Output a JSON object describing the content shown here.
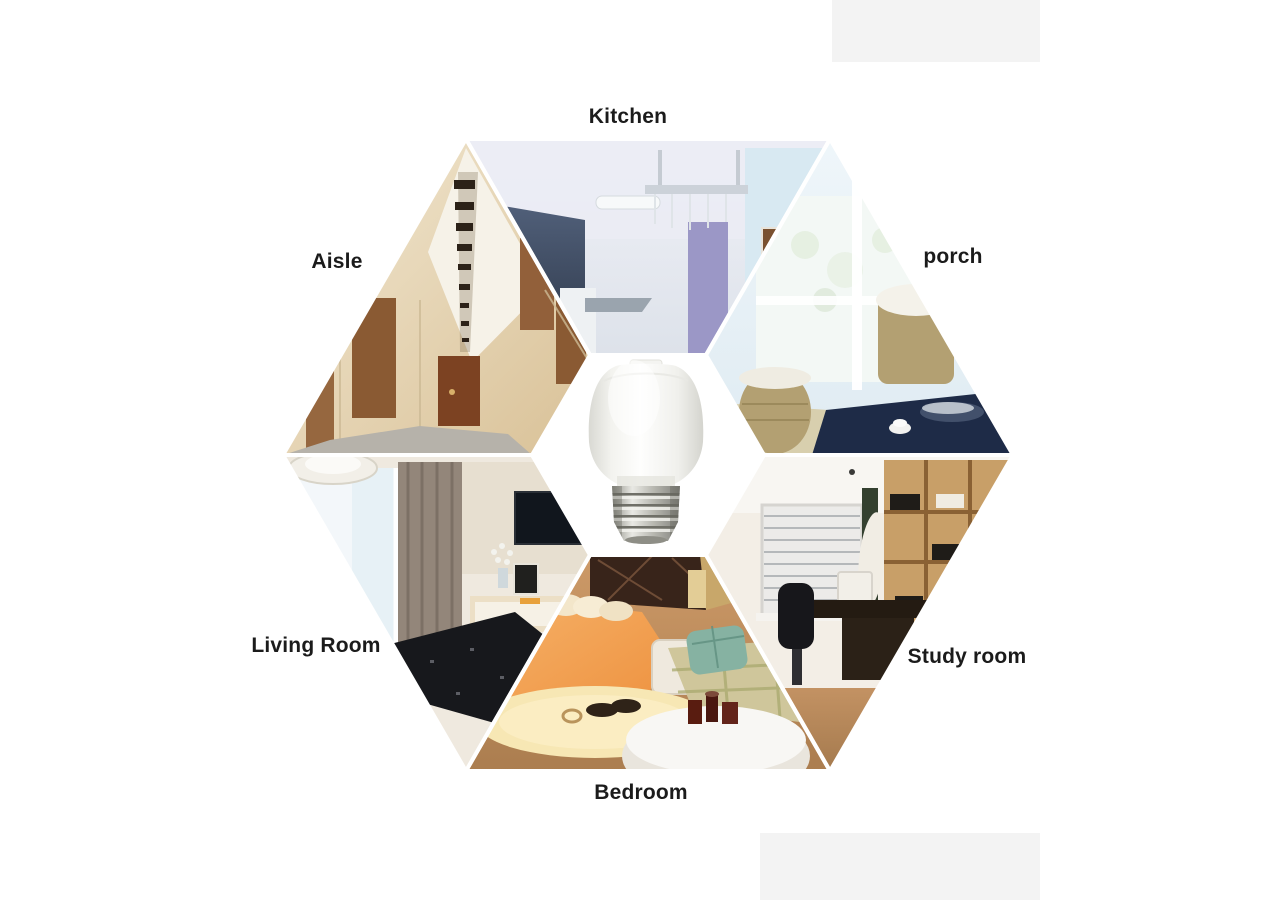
{
  "canvas": {
    "width": 1280,
    "height": 900,
    "background": "#ffffff"
  },
  "collage": {
    "type": "hexagon-photo-montage",
    "center_product": {
      "icon": "r63-led-bulb"
    },
    "segments": [
      {
        "id": "kitchen",
        "label": "Kitchen",
        "position": "top",
        "palette": [
          "#e9ebf3",
          "#42526b",
          "#9b97c6",
          "#d8e9f2"
        ]
      },
      {
        "id": "porch",
        "label": "porch",
        "position": "top-right",
        "palette": [
          "#eef5fa",
          "#b3a072",
          "#1e2b47",
          "#f3f8f5"
        ]
      },
      {
        "id": "study-room",
        "label": "Study room",
        "position": "bottom-right",
        "palette": [
          "#c89f68",
          "#241b12",
          "#ecebe9",
          "#b98d5a"
        ]
      },
      {
        "id": "bedroom",
        "label": "Bedroom",
        "position": "bottom",
        "palette": [
          "#ef9b4e",
          "#38241a",
          "#f7e7b4",
          "#cfc69b"
        ]
      },
      {
        "id": "living-room",
        "label": "Living Room",
        "position": "bottom-left",
        "palette": [
          "#e7f1f6",
          "#93867a",
          "#17181c",
          "#efe9df"
        ]
      },
      {
        "id": "aisle",
        "label": "Aisle",
        "position": "top-left",
        "palette": [
          "#ecdcba",
          "#8a5a33",
          "#f6f2e8",
          "#b6b2aa"
        ]
      }
    ],
    "seam_color": "#ffffff",
    "label_color": "#1b1b1b"
  }
}
